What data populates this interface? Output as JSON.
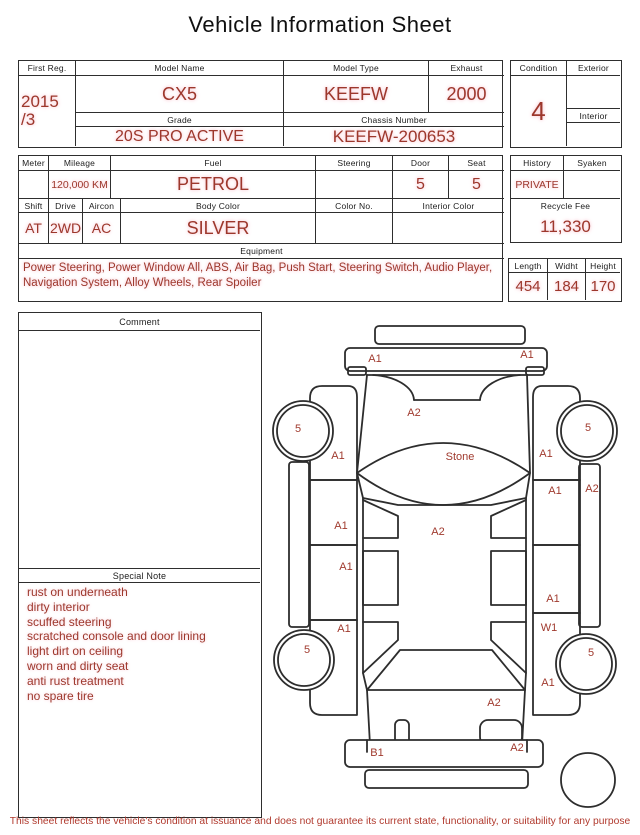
{
  "title": "Vehicle Information Sheet",
  "vehicle": {
    "first_reg_label": "First Reg.",
    "first_reg_line1": "2015",
    "first_reg_line2": "/3",
    "model_name_label": "Model Name",
    "model_name": "CX5",
    "model_type_label": "Model Type",
    "model_type": "KEEFW",
    "exhaust_label": "Exhaust",
    "exhaust": "2000",
    "grade_label": "Grade",
    "grade": "20S PRO ACTIVE",
    "chassis_label": "Chassis Number",
    "chassis_number": "KEEFW-200653"
  },
  "condition": {
    "label": "Condition",
    "value": "4",
    "exterior_label": "Exterior",
    "exterior": "",
    "interior_label": "Interior",
    "interior": ""
  },
  "specs": {
    "meter_label": "Meter",
    "meter": "",
    "mileage_label": "Mileage",
    "mileage": "120,000 KM",
    "fuel_label": "Fuel",
    "fuel": "PETROL",
    "steering_label": "Steering",
    "steering": "",
    "door_label": "Door",
    "door": "5",
    "seat_label": "Seat",
    "seat": "5",
    "shift_label": "Shift",
    "shift": "AT",
    "drive_label": "Drive",
    "drive": "2WD",
    "aircon_label": "Aircon",
    "aircon": "AC",
    "body_color_label": "Body Color",
    "body_color": "SILVER",
    "color_no_label": "Color No.",
    "color_no": "",
    "interior_color_label": "Interior Color",
    "interior_color": ""
  },
  "history": {
    "label": "History",
    "value": "PRIVATE",
    "syaken_label": "Syaken",
    "syaken": "",
    "recycle_label": "Recycle Fee",
    "recycle_fee": "11,330"
  },
  "equipment": {
    "label": "Equipment",
    "value": "Power Steering, Power Window All, ABS, Air Bag, Push Start, Steering Switch, Audio Player, Navigation System, Alloy Wheels, Rear Spoiler"
  },
  "dimensions": {
    "length_label": "Length",
    "length": "454",
    "width_label": "Widht",
    "width": "184",
    "height_label": "Height",
    "height": "170"
  },
  "comment": {
    "label": "Comment",
    "value": ""
  },
  "special_note": {
    "label": "Special Note",
    "items": [
      "rust on underneath",
      "dirty interior",
      "scuffed steering",
      "scratched console and door lining",
      "light dirt on ceiling",
      "worn and dirty seat",
      "anti rust treatment",
      "no spare tire"
    ]
  },
  "diagram": {
    "labels": [
      {
        "text": "A1",
        "x": 105,
        "y": 47
      },
      {
        "text": "A1",
        "x": 257,
        "y": 43
      },
      {
        "text": "A2",
        "x": 144,
        "y": 101
      },
      {
        "text": "5",
        "x": 28,
        "y": 117
      },
      {
        "text": "5",
        "x": 318,
        "y": 116
      },
      {
        "text": "A1",
        "x": 68,
        "y": 144
      },
      {
        "text": "Stone",
        "x": 190,
        "y": 145
      },
      {
        "text": "A1",
        "x": 276,
        "y": 142
      },
      {
        "text": "A1",
        "x": 285,
        "y": 179
      },
      {
        "text": "A2",
        "x": 322,
        "y": 177
      },
      {
        "text": "A1",
        "x": 71,
        "y": 214
      },
      {
        "text": "A2",
        "x": 168,
        "y": 220
      },
      {
        "text": "A1",
        "x": 76,
        "y": 255
      },
      {
        "text": "A1",
        "x": 283,
        "y": 287
      },
      {
        "text": "A1",
        "x": 74,
        "y": 317
      },
      {
        "text": "W1",
        "x": 279,
        "y": 316
      },
      {
        "text": "5",
        "x": 37,
        "y": 338
      },
      {
        "text": "5",
        "x": 321,
        "y": 341
      },
      {
        "text": "A1",
        "x": 278,
        "y": 371
      },
      {
        "text": "A2",
        "x": 224,
        "y": 391
      },
      {
        "text": "B1",
        "x": 107,
        "y": 441
      },
      {
        "text": "A2",
        "x": 247,
        "y": 436
      }
    ]
  },
  "disclaimer": "This sheet reflects the vehicle's condition at issuance and does not guarantee its current state, functionality, or suitability for any purpose",
  "colors": {
    "accent": "#9d372c",
    "border": "#2e2e2e"
  }
}
